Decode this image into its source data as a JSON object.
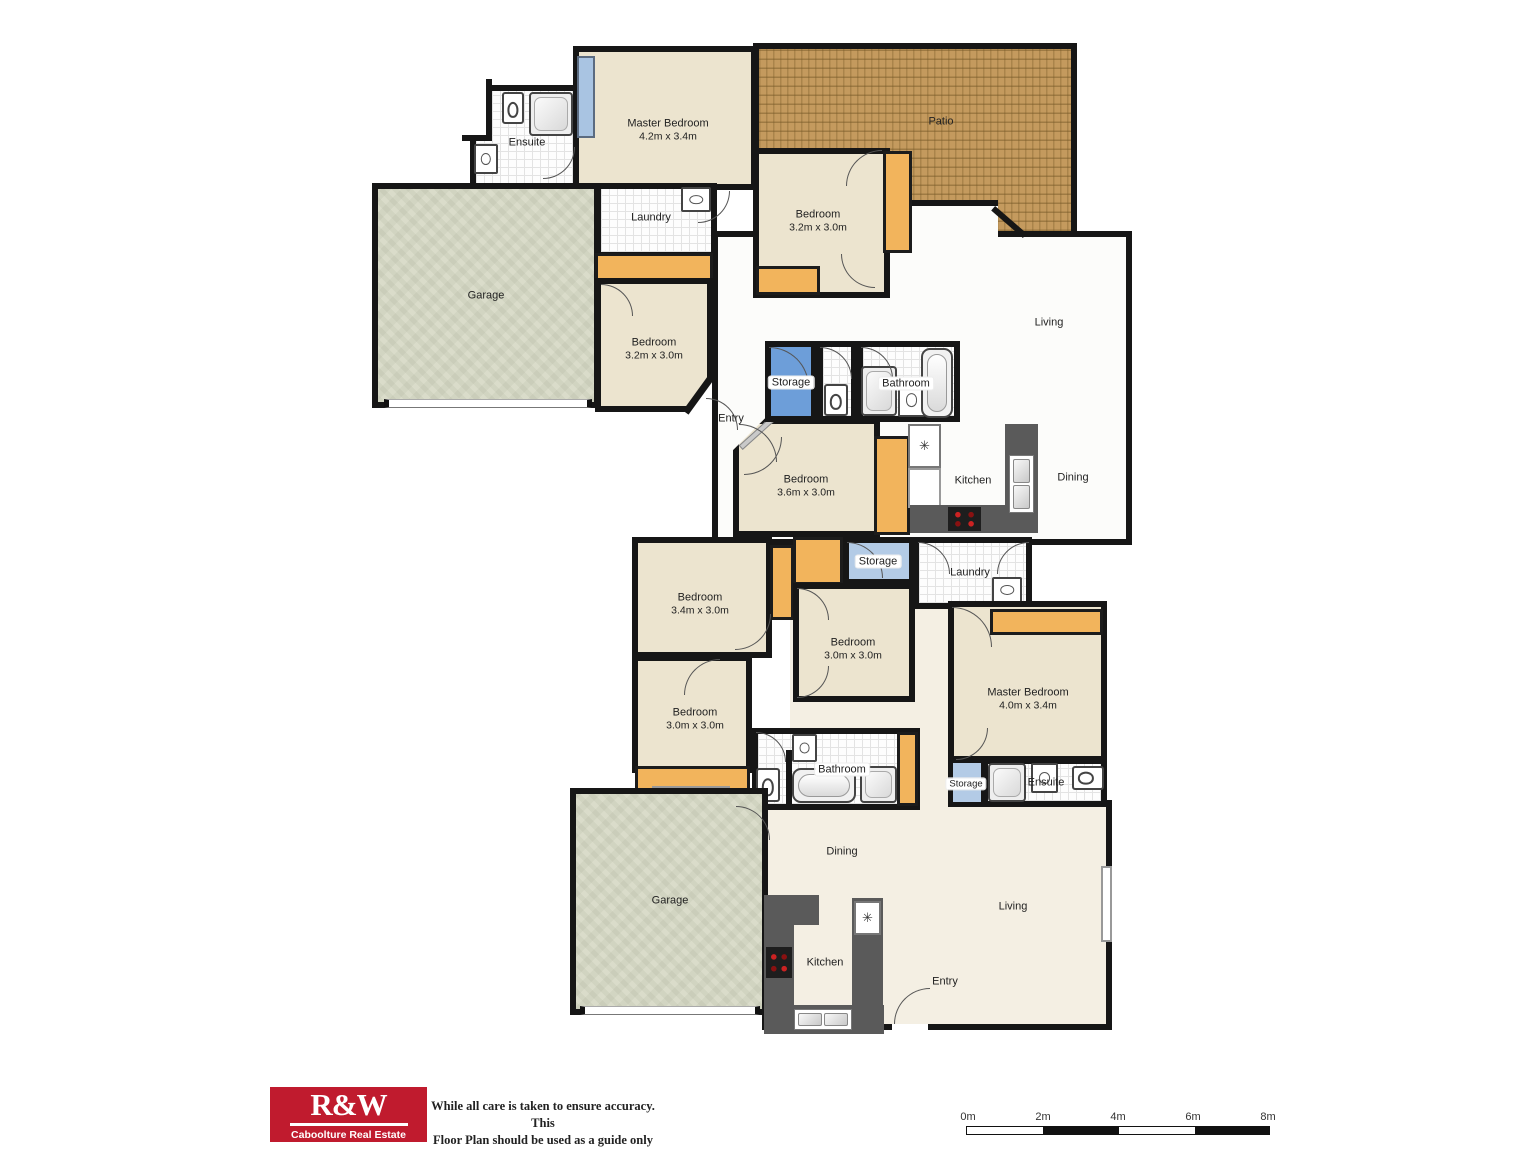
{
  "unit1": {
    "ensuite": {
      "label": "Ensuite"
    },
    "master_bedroom": {
      "label": "Master Bedroom",
      "dims": "4.2m x 3.4m"
    },
    "patio": {
      "label": "Patio"
    },
    "laundry": {
      "label": "Laundry"
    },
    "bedroom_right": {
      "label": "Bedroom",
      "dims": "3.2m x 3.0m"
    },
    "garage": {
      "label": "Garage"
    },
    "bedroom_left": {
      "label": "Bedroom",
      "dims": "3.2m x 3.0m"
    },
    "living": {
      "label": "Living"
    },
    "storage": {
      "label": "Storage"
    },
    "bathroom": {
      "label": "Bathroom"
    },
    "entry": {
      "label": "Entry"
    },
    "bedroom_mid": {
      "label": "Bedroom",
      "dims": "3.6m x 3.0m"
    },
    "kitchen": {
      "label": "Kitchen"
    },
    "dining": {
      "label": "Dining"
    }
  },
  "unit2": {
    "bedroom_top": {
      "label": "Bedroom",
      "dims": "3.4m x 3.0m"
    },
    "storage_top": {
      "label": "Storage"
    },
    "laundry": {
      "label": "Laundry"
    },
    "bedroom_mid": {
      "label": "Bedroom",
      "dims": "3.0m x 3.0m"
    },
    "master_bedroom": {
      "label": "Master Bedroom",
      "dims": "4.0m x 3.4m"
    },
    "bedroom_left": {
      "label": "Bedroom",
      "dims": "3.0m x 3.0m"
    },
    "bathroom": {
      "label": "Bathroom"
    },
    "storage_small": {
      "label": "Storage"
    },
    "ensuite": {
      "label": "Ensuite"
    },
    "garage": {
      "label": "Garage"
    },
    "dining": {
      "label": "Dining"
    },
    "kitchen": {
      "label": "Kitchen"
    },
    "living": {
      "label": "Living"
    },
    "entry": {
      "label": "Entry"
    }
  },
  "icons": {
    "fridge": "✳"
  },
  "footer": {
    "logo_title": "R&W",
    "logo_subtitle": "Caboolture Real Estate",
    "disclaimer_line1": "While all care is taken to ensure accuracy. This",
    "disclaimer_line2": "Floor Plan should be used as a guide only"
  },
  "scalebar": {
    "labels": [
      "0m",
      "2m",
      "4m",
      "6m",
      "8m"
    ]
  },
  "colors": {
    "wall": "#161616",
    "cream": "#ece4cf",
    "patio": "#c49a5e",
    "garage": "#dadcca",
    "orange": "#f2b45c",
    "blue": "#6d9ed9",
    "lightblue": "#b3cbe6",
    "winblue": "#a9c4e2",
    "counter": "#5a5a5a",
    "logored": "#c01b2e"
  }
}
